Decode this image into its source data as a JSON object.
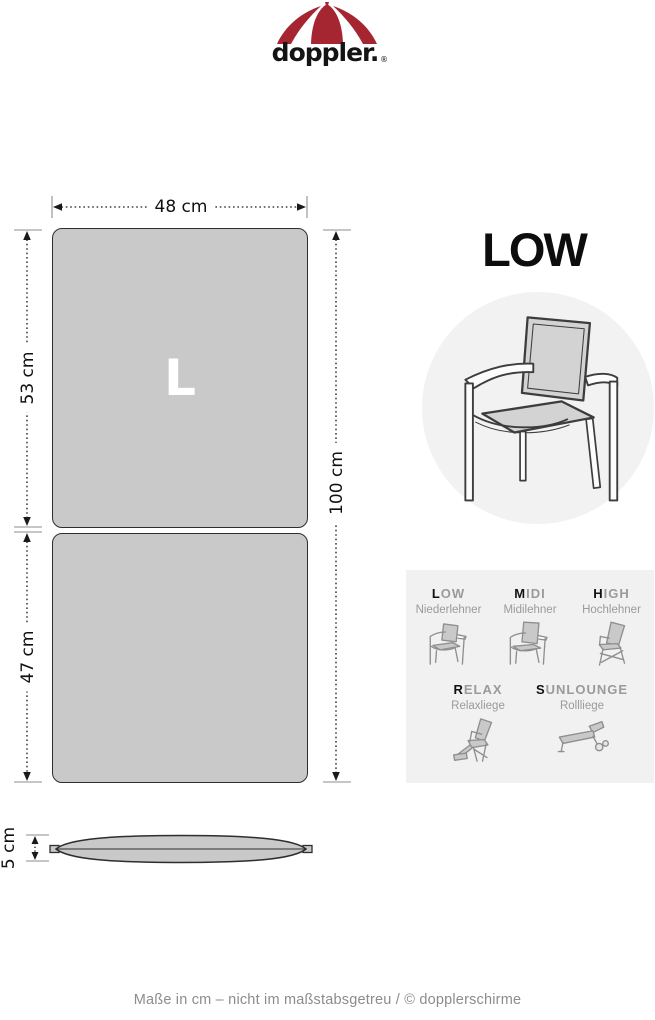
{
  "brand": {
    "wordmark": "doppler.",
    "registered": "®",
    "logo_icon": "umbrella-icon",
    "red": "#a52530"
  },
  "cushion": {
    "size_label": "L",
    "width": "48 cm",
    "back_length": "53 cm",
    "seat_length": "47 cm",
    "total_length": "100 cm",
    "thickness": "5 cm",
    "fill_color": "#c9c9c9",
    "outline_color": "#2e2e2e"
  },
  "variant": {
    "title": "LOW",
    "illustration": "low-back-armchair"
  },
  "type_legend": {
    "background": "#f1f1f1",
    "row1": [
      {
        "lead": "L",
        "rest": "OW",
        "name": "Niederlehner",
        "icon": "chair-low-icon"
      },
      {
        "lead": "M",
        "rest": "IDI",
        "name": "Midilehner",
        "icon": "chair-midi-icon"
      },
      {
        "lead": "H",
        "rest": "IGH",
        "name": "Hochlehner",
        "icon": "chair-high-icon"
      }
    ],
    "row2": [
      {
        "lead": "R",
        "rest": "ELAX",
        "name": "Relaxliege",
        "icon": "recliner-icon"
      },
      {
        "lead": "S",
        "rest": "UNLOUNGE",
        "name": "Rollliege",
        "icon": "sunlounger-icon"
      }
    ]
  },
  "footer": {
    "text": "Maße in cm – nicht im maßstabsgetreu / © dopplerschirme"
  }
}
